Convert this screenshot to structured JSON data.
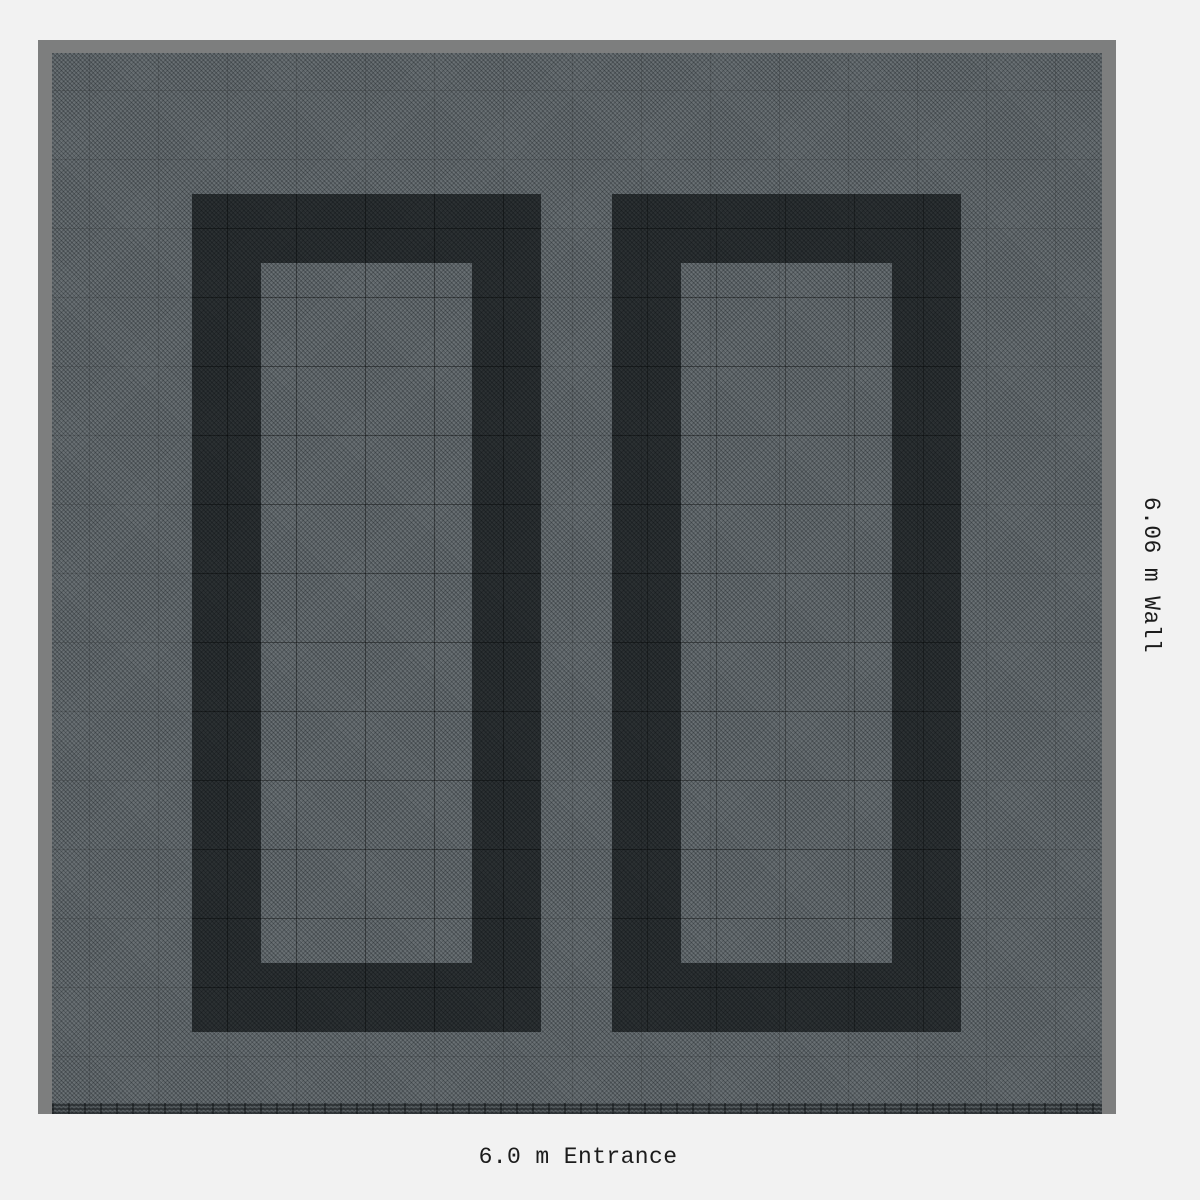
{
  "labels": {
    "wall": "6.06 m Wall",
    "entrance": "6.0 m Entrance"
  },
  "colors": {
    "page_bg": "#f2f2f2",
    "wall_gray": "#7d7e7e",
    "floor_gray": "#575e62",
    "floor_weave_line": "#3f464a",
    "obstacle_dark": "#26292b",
    "label_text": "#1c1c1c"
  }
}
